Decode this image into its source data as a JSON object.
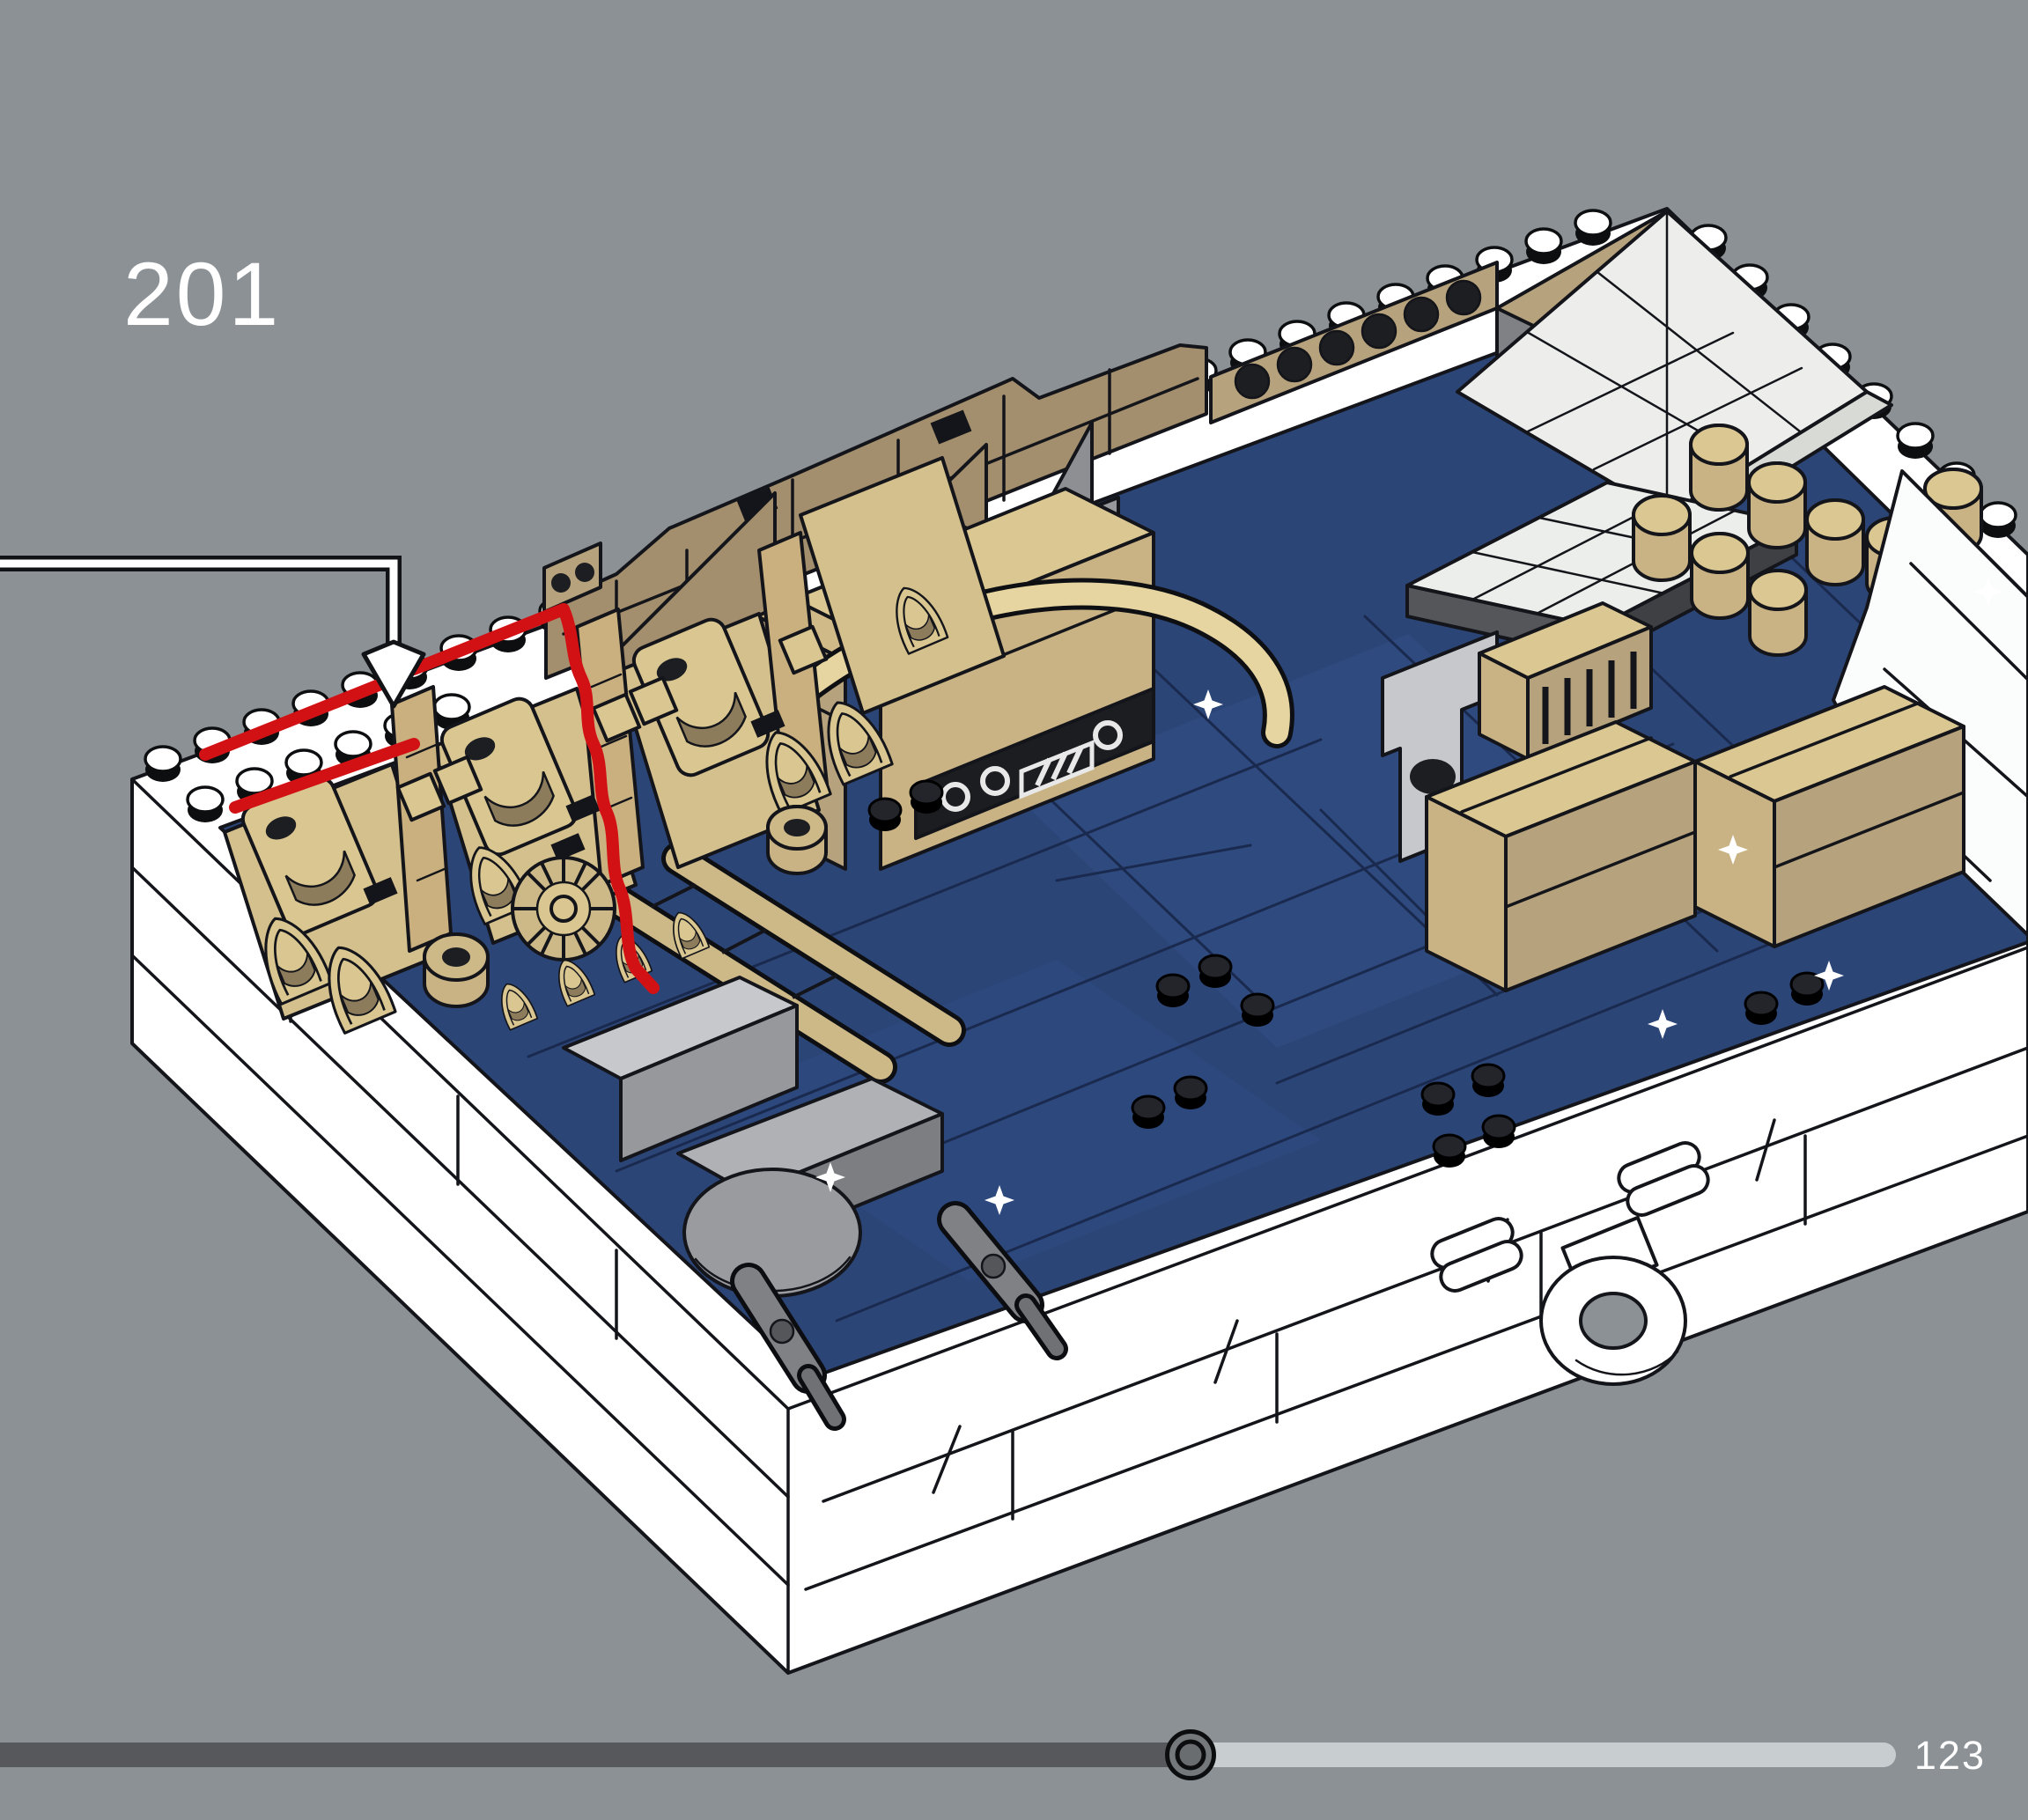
{
  "page": {
    "background_color": "#8b9195",
    "step_number": "201",
    "page_number": "123"
  },
  "callout": {
    "shape": "elbow-arrow",
    "stroke_color": "#ffffff",
    "outline_color": "#121316",
    "target": "red-highlighted engine vane pieces"
  },
  "highlight": {
    "color": "#d21114"
  },
  "model": {
    "kind": "isometric LEGO diorama build on framed starfield base",
    "frame_color": "#ffffff",
    "deck_color": "#2c4577",
    "deck_star_color": "#ffffff",
    "tan_light": "#d9c690",
    "tan_mid": "#c9b384",
    "tan_dark": "#a38e6d",
    "gray_light": "#c7c8cb",
    "gray_mid": "#97989c",
    "gray_dark": "#6a6b6f",
    "hose_color": "#e6d5a0",
    "glass_color": "#edeeec"
  },
  "progress": {
    "fraction": 0.628,
    "track_color": "#c8cdd0",
    "fill_color": "#57585b",
    "handle_fill": "#75787b",
    "handle_ring": "#0c0d0f"
  }
}
